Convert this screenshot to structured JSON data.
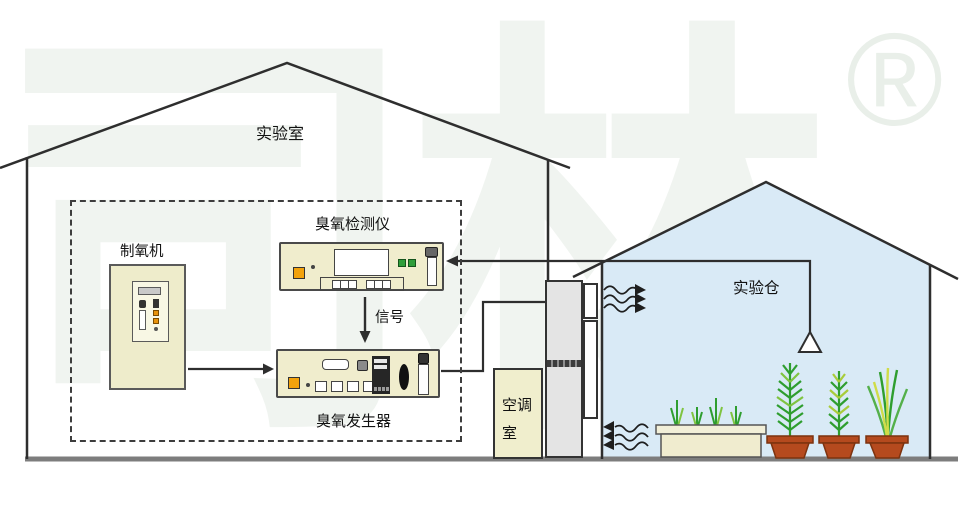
{
  "watermark": {
    "brand": "司林",
    "registered": "®"
  },
  "labels": {
    "laboratory": "实验室",
    "oxygen_machine": "制氧机",
    "ozone_detector": "臭氧检测仪",
    "signal": "信号",
    "ozone_generator": "臭氧发生器",
    "ac_room": "空调室",
    "experiment_chamber": "实验仓"
  },
  "colors": {
    "equipment_beige": "#f0edcd",
    "greenhouse_blue": "#d9eaf6",
    "outline_dark": "#2e2e2e",
    "floor_gray": "#7d7d7d",
    "hvac_gray": "#e4e4e4",
    "pot_terracotta": "#b54a1e",
    "plant_green": "#2f9e2f",
    "plant_light_green": "#7fc440",
    "grass_yellow": "#cfdc48",
    "accent_orange": "#f2a20c",
    "indicator_green": "#2f9e3a",
    "watermark_gray": "#f0f4f0"
  }
}
